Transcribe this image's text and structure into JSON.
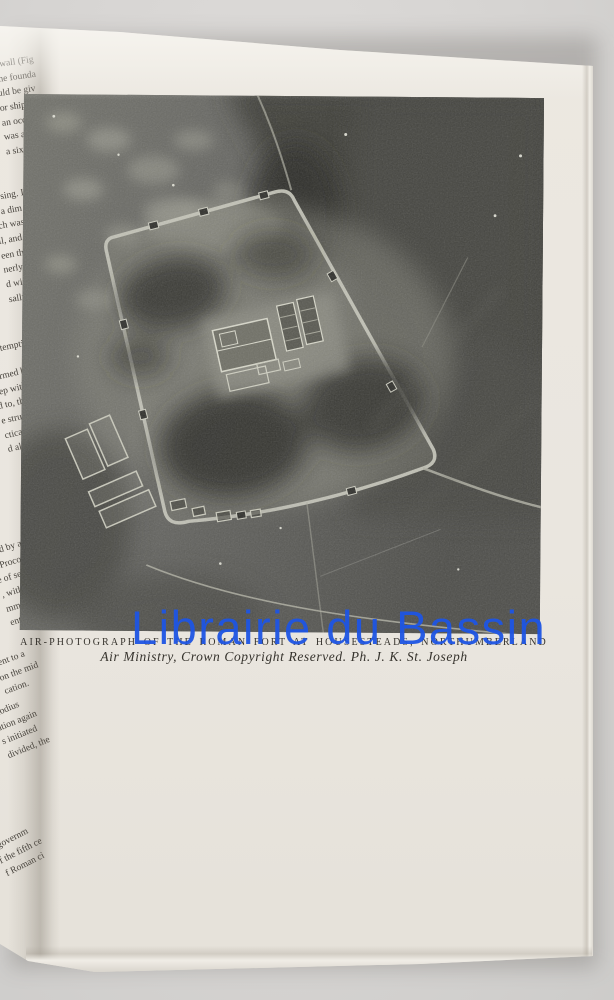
{
  "watermark": {
    "text": "Librairie du Bassin",
    "color": "#1e55e4"
  },
  "plate": {
    "caption_line1": "AIR-PHOTOGRAPH OF THE ROMAN FORT AT HOUSESTEADS, NORTHUMBERLAND",
    "caption_line2": "Air Ministry, Crown Copyright Reserved. Ph. J. K. St. Joseph"
  },
  "colors": {
    "backdrop": "#d6d4d2",
    "page": "#eae6df",
    "caption_ink": "#36332d"
  },
  "left_page": {
    "blocks": [
      {
        "lines": [
          "r wall (Fig",
          "the founda",
          "uld be giv",
          "or ships",
          "an occupy",
          "was a mu",
          "a six-ton"
        ]
      },
      {
        "lines": [
          "posing. It",
          "t, a dim",
          "ich was",
          "ll, and a",
          "een the",
          "nerly a",
          "d with",
          "sally on"
        ]
      },
      {
        "lines": [
          "tempting to"
        ]
      },
      {
        "lines": [
          "formed by",
          "eep with",
          "d to, the W",
          "e structu",
          "ctical conn",
          "d along it"
        ]
      },
      {
        "lines": [
          "ised by a Leg",
          "a Procon",
          "e of self-gov",
          ", with consid",
          "mmunities wer",
          "ent to a con"
        ]
      },
      {
        "lines": [
          "sent to a",
          "on the mid",
          "cation."
        ]
      },
      {
        "lines": [
          "Clodius",
          "ution again",
          "s initiated",
          "divided, the"
        ]
      },
      {
        "lines": [
          "l governm",
          "f the fifth ce",
          "f Roman ci"
        ]
      }
    ]
  }
}
